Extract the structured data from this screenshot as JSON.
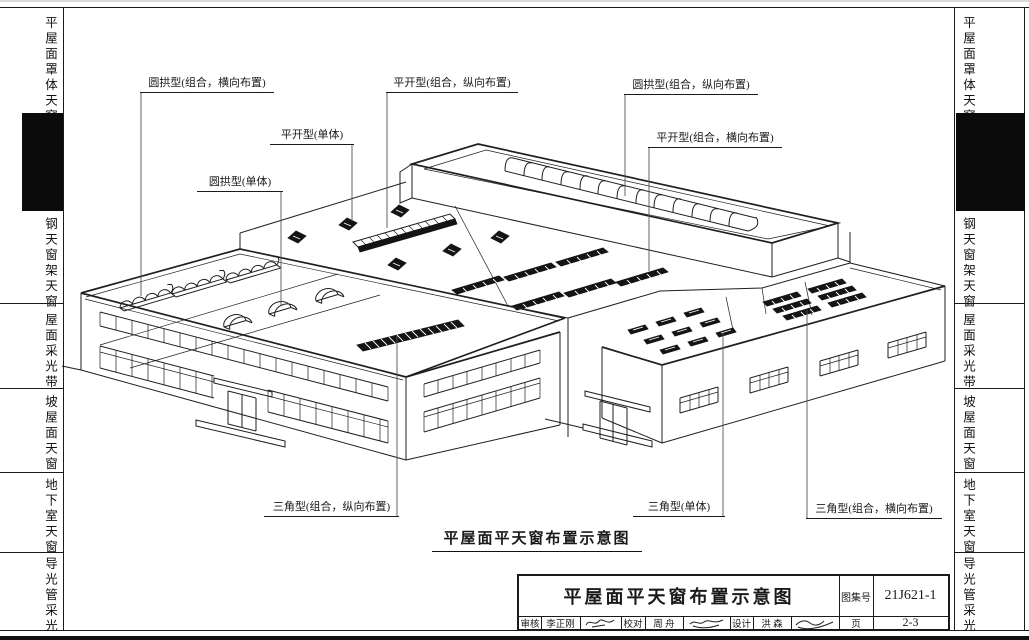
{
  "sidebar": {
    "items": [
      "平屋面罩体天窗",
      "钢天窗架天窗",
      "屋面采光带",
      "坡屋面天窗",
      "地下室天窗",
      "导光管采光"
    ],
    "active_tab": "current-chapter-black-tab"
  },
  "callouts": {
    "c1": "圆拱型(组合，横向布置)",
    "c2": "平开型(组合，纵向布置)",
    "c3": "平开型(单体)",
    "c4": "圆拱型(单体)",
    "c5": "圆拱型(组合，纵向布置)",
    "c6": "平开型(组合，横向布置)",
    "c7": "三角型(组合，纵向布置)",
    "c8": "三角型(单体)",
    "c9": "三角型(组合，横向布置)"
  },
  "caption": "平屋面平天窗布置示意图",
  "titleblock": {
    "title": "平屋面平天窗布置示意图",
    "atlas_label": "图集号",
    "atlas_no": "21J621-1",
    "page_label": "页",
    "page_no": "2-3",
    "review_label": "审核",
    "reviewer": "李正刚",
    "proof_label": "校对",
    "proofreader": "周 舟",
    "design_label": "设计",
    "designer": "洪 森",
    "signatures": {
      "review": "signature-scribble",
      "proof": "signature-scribble",
      "design": "signature-scribble"
    }
  },
  "colors": {
    "line": "#1a1a1a",
    "paper": "#ffffff",
    "tab": "#0b0b0b"
  }
}
